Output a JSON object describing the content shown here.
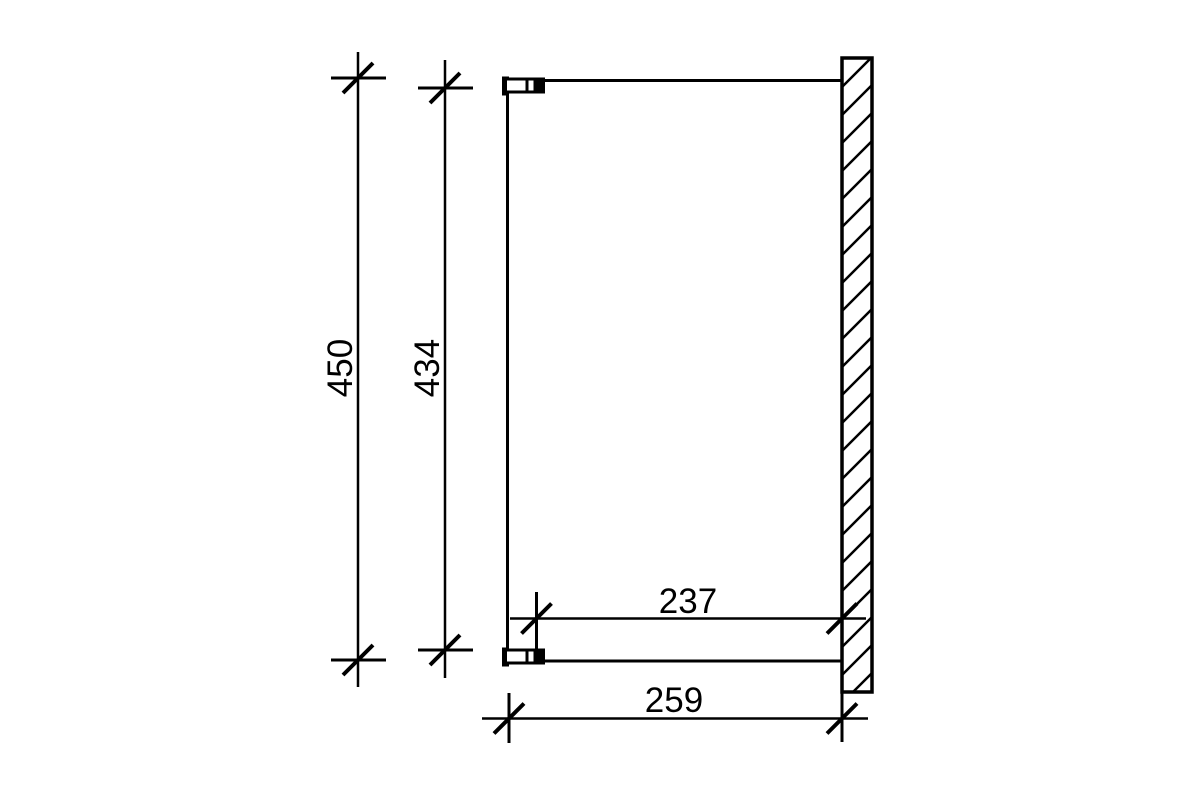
{
  "page": {
    "background": "#ffffff",
    "line_color": "#000000"
  },
  "dimensions": {
    "outer_vertical": "450",
    "inner_vertical": "434",
    "inner_horizontal": "237",
    "outer_horizontal": "259"
  }
}
